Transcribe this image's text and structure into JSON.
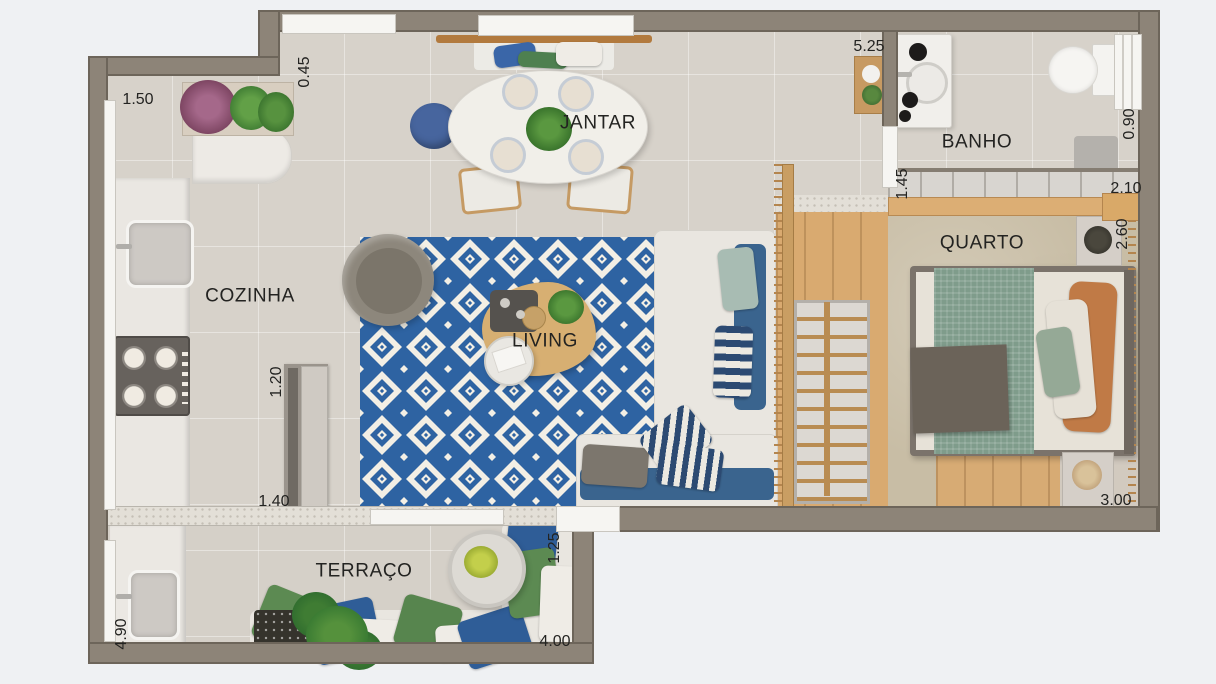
{
  "plan_type": "apartment-floorplan",
  "floorplan": {
    "rooms": [
      {
        "id": "jantar",
        "label": "JANTAR"
      },
      {
        "id": "banho",
        "label": "BANHO"
      },
      {
        "id": "quarto",
        "label": "QUARTO"
      },
      {
        "id": "cozinha",
        "label": "COZINHA"
      },
      {
        "id": "living",
        "label": "LIVING"
      },
      {
        "id": "terraco",
        "label": "TERRAÇO"
      }
    ],
    "dimensions": [
      {
        "id": "dim-1-50",
        "text": "1.50",
        "orientation": "horizontal"
      },
      {
        "id": "dim-0-45",
        "text": "0.45",
        "orientation": "vertical"
      },
      {
        "id": "dim-5-25",
        "text": "5.25",
        "orientation": "horizontal"
      },
      {
        "id": "dim-0-90",
        "text": "0.90",
        "orientation": "vertical"
      },
      {
        "id": "dim-1-45",
        "text": "1.45",
        "orientation": "vertical"
      },
      {
        "id": "dim-2-10",
        "text": "2.10",
        "orientation": "horizontal"
      },
      {
        "id": "dim-2-60",
        "text": "2.60",
        "orientation": "vertical"
      },
      {
        "id": "dim-1-20",
        "text": "1.20",
        "orientation": "vertical"
      },
      {
        "id": "dim-1-40",
        "text": "1.40",
        "orientation": "horizontal"
      },
      {
        "id": "dim-1-25",
        "text": "1.25",
        "orientation": "vertical"
      },
      {
        "id": "dim-4-90",
        "text": "4.90",
        "orientation": "vertical"
      },
      {
        "id": "dim-4-00",
        "text": "4.00",
        "orientation": "horizontal"
      },
      {
        "id": "dim-3-00",
        "text": "3.00",
        "orientation": "horizontal"
      }
    ],
    "colors": {
      "background": "#eff1f3",
      "wall": "#8d8478",
      "floor_tile": "#d7d2ca",
      "rug_blue": "#2e63a2",
      "rug_white": "#f3efe5",
      "wood": "#d8aa70",
      "carpet": "#c8bda5",
      "sofa_cream": "#e9e6e0",
      "sofa_blue": "#3a648e",
      "terrace_green": "#5c8a52",
      "terrace_blue": "#2f5d97",
      "bed_green": "#7f9c8b",
      "bed_orange": "#c07a46"
    }
  }
}
